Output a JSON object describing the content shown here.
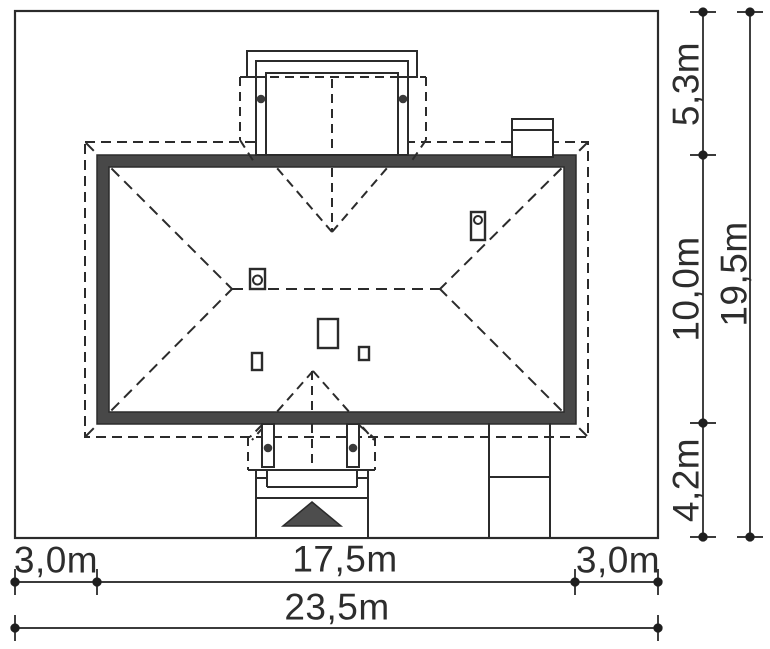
{
  "drawing": {
    "kind": "house-site-plan-roof-view",
    "scale_px_per_m": 27
  },
  "dimensions": {
    "bottom": {
      "left_setback": "3,0m",
      "house_width": "17,5m",
      "right_setback": "3,0m",
      "total_width": "23,5m"
    },
    "right": {
      "top_setback": "5,3m",
      "house_depth": "10,0m",
      "bottom_setback": "4,2m",
      "total_depth": "19,5m"
    }
  },
  "colors": {
    "line": "#2b2b2b",
    "dim_line": "#1f1f1f",
    "roof_band_fill": "#484848",
    "arrow_fill": "#4d4d4d",
    "column_dot": "#3a3a3a",
    "background": "#ffffff",
    "text": "#2d2d2d"
  }
}
